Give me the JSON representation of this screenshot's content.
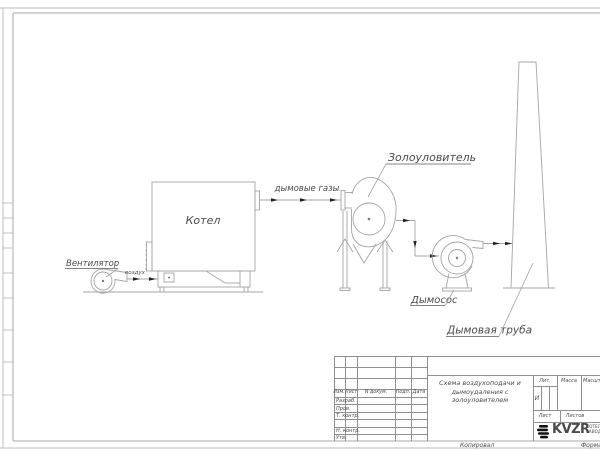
{
  "drawing": {
    "colors": {
      "line": "#a4a4a4",
      "arrow": "#222222",
      "text": "#4a4a4a",
      "frame": "#b8b8b8",
      "title_line": "#8f8f8f",
      "logo": "#111111"
    },
    "labels": {
      "fan": "Вентилятор",
      "air": "воздух",
      "boiler": "Котел",
      "flue_gases": "дымовые газы",
      "ash_collector": "Золоуловитель",
      "smoke_exhauster": "Дымосос",
      "chimney": "Дымовая труба"
    }
  },
  "title_block": {
    "columns": {
      "izm": "Изм.",
      "list": "Лист",
      "n_dokum": "N докум.",
      "podp": "Подп.",
      "data": "Дата"
    },
    "rows": {
      "razrab": "Разраб.",
      "prov": "Пров.",
      "t_kontr": "Т. контр.",
      "n_kontr": "Н. контр.",
      "utv": "Утв."
    },
    "title_line1": "Схема воздухоподачи и",
    "title_line2": "дымоудаления с",
    "title_line3": "золоуловителем",
    "lit_label": "Лит.",
    "lit_value": "И",
    "massa_label": "Масса",
    "masshtab_label": "Масштаб",
    "list_label": "Лист",
    "listov_label": "Листов",
    "logo_text": "KVZR",
    "logo_sub_line1": "КОТЕЛЬНЫЙ",
    "logo_sub_line2": "ЗАВОД",
    "kopiroval": "Копировал",
    "format_label": "Формат"
  }
}
